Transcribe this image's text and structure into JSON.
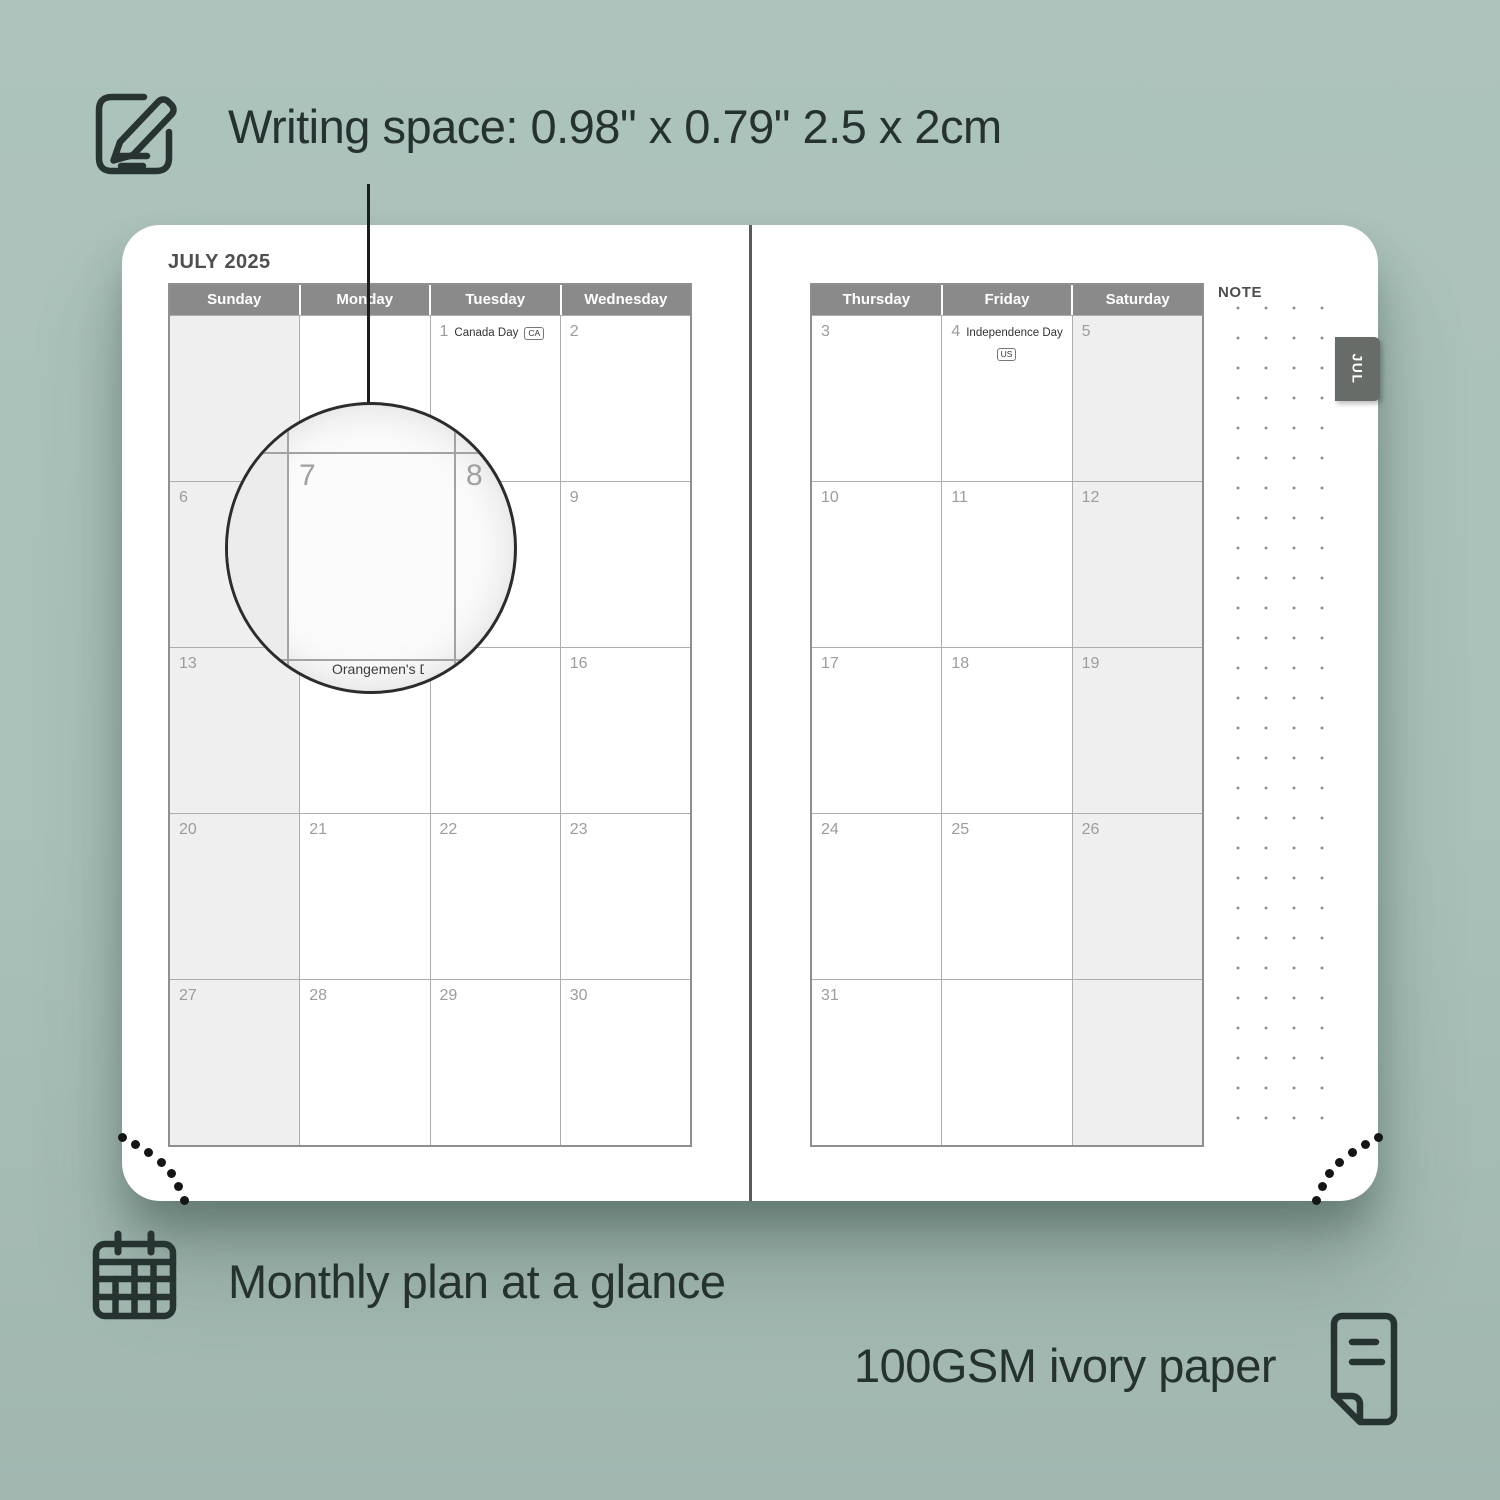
{
  "background_color": "#a9c1b9",
  "accent_text_color": "#26322f",
  "annotations": {
    "writing_space_label": "Writing space: 0.98\" x 0.79\" 2.5 x 2cm",
    "monthly_plan_label": "Monthly plan at a glance",
    "paper_label": "100GSM ivory paper"
  },
  "planner": {
    "month_title": "JULY 2025",
    "tab_label": "JUL",
    "note_label": "NOTE",
    "header_bg": "#8a8a8a",
    "weekend_bg": "#efefef",
    "tab_bg": "#676c69",
    "left_page": {
      "day_headers": [
        "Sunday",
        "Monday",
        "Tuesday",
        "Wednesday"
      ],
      "weeks": [
        [
          null,
          null,
          1,
          2
        ],
        [
          6,
          7,
          8,
          9
        ],
        [
          13,
          14,
          15,
          16
        ],
        [
          20,
          21,
          22,
          23
        ],
        [
          27,
          28,
          29,
          30
        ]
      ]
    },
    "right_page": {
      "day_headers": [
        "Thursday",
        "Friday",
        "Saturday"
      ],
      "weeks": [
        [
          3,
          4,
          5
        ],
        [
          10,
          11,
          12
        ],
        [
          17,
          18,
          19
        ],
        [
          24,
          25,
          26
        ],
        [
          31,
          null,
          null
        ]
      ]
    },
    "holidays": [
      {
        "day": 1,
        "label": "Canada Day",
        "badge": "CA",
        "badge_below": false
      },
      {
        "day": 4,
        "label": "Independence Day",
        "badge": "US",
        "badge_below": true
      }
    ]
  },
  "magnifier": {
    "left_day": "7",
    "right_day": "8",
    "clipped_text": "Orangemen's Day"
  }
}
